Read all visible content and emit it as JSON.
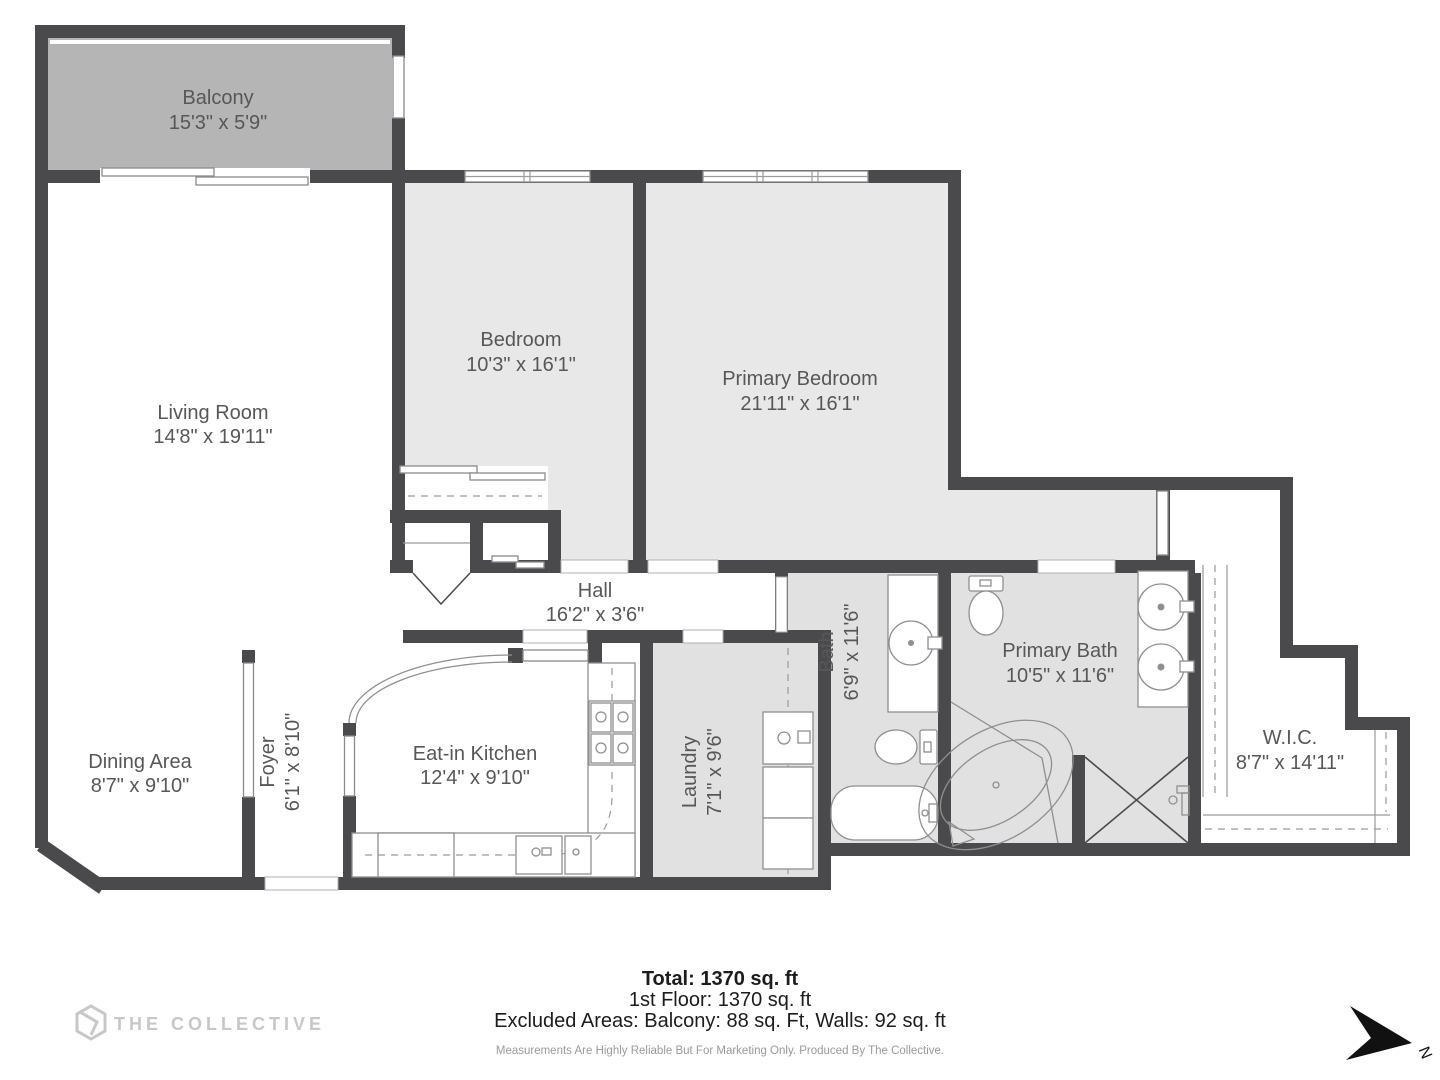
{
  "branding": {
    "logo_text": "THE COLLECTIVE"
  },
  "compass": {
    "north_label": "N"
  },
  "rooms": {
    "balcony": {
      "name": "Balcony",
      "dims": "15'3\" x 5'9\""
    },
    "living_room": {
      "name": "Living Room",
      "dims": "14'8\" x 19'11\""
    },
    "bedroom": {
      "name": "Bedroom",
      "dims": "10'3\" x 16'1\""
    },
    "primary_bedroom": {
      "name": "Primary Bedroom",
      "dims": "21'11\" x 16'1\""
    },
    "hall": {
      "name": "Hall",
      "dims": "16'2\" x 3'6\""
    },
    "dining": {
      "name": "Dining Area",
      "dims": "8'7\" x 9'10\""
    },
    "foyer": {
      "name": "Foyer",
      "dims": "6'1\" x 8'10\""
    },
    "kitchen": {
      "name": "Eat-in Kitchen",
      "dims": "12'4\" x 9'10\""
    },
    "laundry": {
      "name": "Laundry",
      "dims": "7'1\" x 9'6\""
    },
    "bath": {
      "name": "Bath",
      "dims": "6'9\" x 11'6\""
    },
    "primary_bath": {
      "name": "Primary Bath",
      "dims": "10'5\" x 11'6\""
    },
    "wic": {
      "name": "W.I.C.",
      "dims": "8'7\" x 14'11\""
    }
  },
  "summary": {
    "total": "Total: 1370 sq. ft",
    "floor": "1st Floor: 1370 sq. ft",
    "excluded": "Excluded Areas: Balcony: 88 sq. Ft, Walls: 92 sq. ft",
    "disclaimer": "Measurements Are Highly Reliable But For Marketing Only. Produced By The Collective."
  },
  "colors": {
    "wall": "#4a4a4c",
    "balcony_fill": "#b5b5b5",
    "bedroom_fill": "#e8e8e8",
    "bath_fill": "#e1e1e1",
    "label": "#575757"
  }
}
